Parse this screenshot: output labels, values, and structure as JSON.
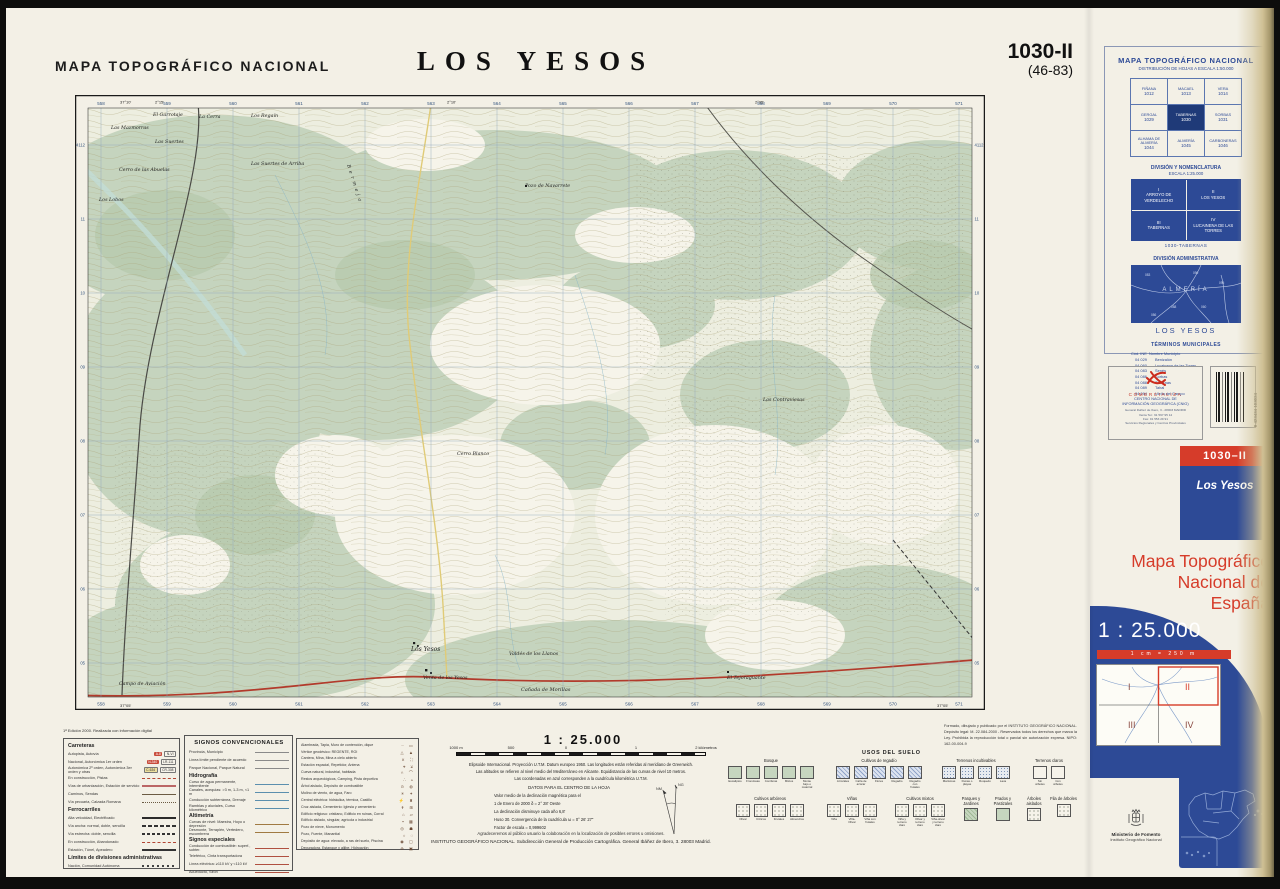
{
  "page": {
    "header_left": "MAPA TOPOGRÁFICO NACIONAL",
    "title": "LOS YESOS",
    "sheet_number": "1030-II",
    "sheet_code": "(46-83)"
  },
  "map": {
    "grid_top": [
      "558",
      "559",
      "560",
      "561",
      "562",
      "563",
      "564",
      "565",
      "566",
      "567",
      "568",
      "569",
      "570",
      "571"
    ],
    "grid_left": [
      "4112",
      "11",
      "10",
      "09",
      "08",
      "07",
      "06",
      "05"
    ],
    "corner_coords": {
      "top_left_lon": "2°15'",
      "top_mid_lon": "2°10'",
      "top_right_lon": "2°05'",
      "left_lat": "37°10'",
      "bottom_lat": "37°05'"
    },
    "places": [
      {
        "name": "El Garrotaje",
        "x": 78,
        "y": 21
      },
      {
        "name": "La Cerra",
        "x": 124,
        "y": 23
      },
      {
        "name": "Los Regaín",
        "x": 176,
        "y": 22
      },
      {
        "name": "Las Mazmorras",
        "x": 36,
        "y": 34
      },
      {
        "name": "Las Suertes",
        "x": 80,
        "y": 48
      },
      {
        "name": "Cerro de las Abuelas",
        "x": 44,
        "y": 76
      },
      {
        "name": "Los Lobos",
        "x": 24,
        "y": 106
      },
      {
        "name": "Las Suertes de Arriba",
        "x": 176,
        "y": 70
      },
      {
        "name": "Pozo de Navarrete",
        "x": 450,
        "y": 92
      },
      {
        "name": "Bermeja",
        "x": 272,
        "y": 70,
        "r": 72,
        "ls": 3
      },
      {
        "name": "Las Contraviesas",
        "x": 688,
        "y": 306
      },
      {
        "name": "Cerro Blanco",
        "x": 382,
        "y": 360
      },
      {
        "name": "Los Yesos",
        "x": 336,
        "y": 556,
        "s": 6
      },
      {
        "name": "Valdés de los Llanos",
        "x": 434,
        "y": 560
      },
      {
        "name": "Venta de los Yesos",
        "x": 348,
        "y": 584
      },
      {
        "name": "Cañada de Morillas",
        "x": 446,
        "y": 596,
        "s": 5
      },
      {
        "name": "El Tejoraguante",
        "x": 652,
        "y": 584
      },
      {
        "name": "Campo de Aviación",
        "x": 44,
        "y": 590
      }
    ]
  },
  "sidebar": {
    "distribution": {
      "title": "MAPA TOPOGRÁFICO NACIONAL",
      "subtitle": "DISTRIBUCIÓN DE HOJAS A ESCALA 1:50.000",
      "cells": [
        {
          "name": "FIÑANA",
          "num": "1012",
          "hl": false
        },
        {
          "name": "MACAEL",
          "num": "1013",
          "hl": false
        },
        {
          "name": "VERA",
          "num": "1014",
          "hl": false
        },
        {
          "name": "GERGAL",
          "num": "1029",
          "hl": false
        },
        {
          "name": "TABERNAS",
          "num": "1030",
          "hl": true
        },
        {
          "name": "SORBAS",
          "num": "1031",
          "hl": false
        },
        {
          "name": "ALHAMA DE ALMERÍA",
          "num": "1044",
          "hl": false
        },
        {
          "name": "ALMERÍA",
          "num": "1045",
          "hl": false
        },
        {
          "name": "CARBONERAS",
          "num": "1046",
          "hl": false
        }
      ]
    },
    "nomenclatura": {
      "title": "DIVISIÓN Y NOMENCLATURA",
      "subtitle": "ESCALA 1:25.000",
      "cells": [
        {
          "roman": "I",
          "name": "ARROYO DE VERDELECHO"
        },
        {
          "roman": "II",
          "name": "LOS YESOS"
        },
        {
          "roman": "III",
          "name": "TABERNAS"
        },
        {
          "roman": "IV",
          "name": "LUCAINENA DE LAS TORRES"
        }
      ],
      "caption": "1030-TABERNAS"
    },
    "admin": {
      "title": "DIVISIÓN ADMINISTRATIVA",
      "region": "ALMERÍA",
      "codes": [
        "083",
        "090",
        "095",
        "088",
        "060",
        "086"
      ],
      "caption": "LOS YESOS"
    },
    "municipios": {
      "title": "TÉRMINOS MUNICIPALES",
      "col1": "Cód. INE",
      "col2": "Nombre Municipio",
      "rows": [
        [
          "04 029",
          "Benizalón"
        ],
        [
          "04 060",
          "Lucainena de las Torres"
        ],
        [
          "04 083",
          "Senés"
        ],
        [
          "04 086",
          "Sorbas"
        ],
        [
          "04 088",
          "Tabernas"
        ],
        [
          "04 089",
          "Tahal"
        ],
        [
          "04 094",
          "Uleila del Campo"
        ]
      ]
    },
    "comercializa": {
      "brand": "COMERCIALIZA",
      "org": [
        "CENTRO NACIONAL DE",
        "INFORMACIÓN GEOGRÁFICA (CNIG)"
      ],
      "address": [
        "General Ibáñez de Ibero, 3 - 28003 MADRID",
        "Venta Tel.: 91 597 95 14",
        "Fax: 91 553 29 91",
        "Servicios Regionales y Centros Provinciales"
      ]
    },
    "barcode_number": "8 423434 103024",
    "sheet_box": {
      "number": "1030–II",
      "name": "Los Yesos"
    },
    "brand_title": [
      "Mapa Topográfico",
      "Nacional de",
      "España"
    ],
    "scale_big": "1 : 25.000",
    "scale_sub": "1 cm = 250 m",
    "quadrants": [
      "I",
      "II",
      "III",
      "IV"
    ],
    "ministry": {
      "line1": "Ministerio de Fomento",
      "line2": "Instituto Geográfico Nacional"
    }
  },
  "legend": {
    "edition_note": "1ª Edición 2000. Realizada con información digital",
    "carreteras": {
      "title": "Carreteras",
      "items": [
        {
          "label": "Autopista, Autovía",
          "badges": [
            {
              "t": "A-8",
              "style": "red"
            },
            {
              "t": "N-VI",
              "style": "outline"
            }
          ]
        },
        {
          "label": "Nacional, Autonómica 1er orden",
          "badges": [
            {
              "t": "N-340",
              "style": "red"
            },
            {
              "t": "LR-111",
              "style": "outline"
            }
          ]
        },
        {
          "label": "Autonómica 2º orden, Autonómica 3er orden y otras",
          "badges": [
            {
              "t": "C-634",
              "style": "yellow"
            },
            {
              "t": "CR-308",
              "style": "outline"
            }
          ]
        },
        {
          "label": "En construcción, Pistas",
          "sw": "constr"
        },
        {
          "label": "Vías de urbanización, Estación de servicio",
          "sw": "serv"
        },
        {
          "label": "Caminos, Sendas",
          "sw": "camino"
        },
        {
          "label": "Vía pecuaria, Calzada Romana",
          "sw": "pecuaria"
        }
      ]
    },
    "ferrocarriles": {
      "title": "Ferrocarriles",
      "items": [
        {
          "label": "Alta velocidad, Electrificado",
          "sw": "hs"
        },
        {
          "label": "Vía ancha: normal, doble, sencilla",
          "sw": "rail2"
        },
        {
          "label": "Vía estrecha: doble, sencilla",
          "sw": "rail1"
        },
        {
          "label": "En construcción, Abandonado",
          "sw": "constr"
        },
        {
          "label": "Estación, Túnel, Apeadero",
          "sw": "station"
        }
      ]
    },
    "limites": {
      "title": "Límites de divisiones administrativas",
      "items": [
        {
          "label": "Nación, Comunidad Autónoma",
          "sw": "limdots"
        }
      ]
    },
    "signos": {
      "title": "SIGNOS CONVENCIONALES",
      "groups": [
        {
          "header": "",
          "color": "#8a8a8a",
          "items": [
            "Provincia, Municipio",
            "Línea límite pendiente de acuerdo",
            "Parque Nacional, Parque Natural"
          ]
        },
        {
          "header": "Hidrografía",
          "color": "#5b8fae",
          "items": [
            "Curso de agua permanente, intermitente",
            "Canales, acequias: >3 m, 1-3 m, <1 m",
            "Conducción subterránea, Drenaje",
            "Ramblas y aluviales, Curso kilométrico"
          ]
        },
        {
          "header": "Altimetría",
          "color": "#a07a42",
          "items": [
            "Curvas de nivel: Maestra, Hoyo o depresión",
            "Desmonte, Terraplén, Vertedero, escombrera"
          ]
        },
        {
          "header": "Signos especiales",
          "color": "#b05040",
          "items": [
            "Conducción de combustible: superf., subter.",
            "Teleférico, Cinta transportadora",
            "Línea eléctrica: ≥110 kV y <110 kV",
            "Acueducto, Sifón"
          ]
        }
      ]
    },
    "simbolos": [
      {
        "label": "Alambrada, Tapia, Muro de contención, dique",
        "gl": "┄ ▭"
      },
      {
        "label": "Vértice geodésico: REGENTE, ROI",
        "gl": "△ ▲"
      },
      {
        "label": "Cantera, Mina, Mina a cielo abierto",
        "gl": "⨯ ⛶"
      },
      {
        "label": "Estación espacial, Repetidor, Antena",
        "gl": "⌖ ⊻"
      },
      {
        "label": "Cueva natural, industrial, habitada",
        "gl": "∩ ⌒"
      },
      {
        "label": "Restos arqueológicos, Camping, Pista deportiva",
        "gl": "∴ ▵"
      },
      {
        "label": "Árbol aislado, Depósito de combustible",
        "gl": "⊙ ◍"
      },
      {
        "label": "Molino de viento, de agua, Faro",
        "gl": "✳ ✦"
      },
      {
        "label": "Central eléctrica: hidráulica, térmica, Castillo",
        "gl": "⚡ ♜"
      },
      {
        "label": "Cruz aislada, Cementerio: Iglesia y cementerio",
        "gl": "✝ ⊞"
      },
      {
        "label": "Edificio religioso: cristiano, Edificio en ruinas, Corral",
        "gl": "⌂ ▱"
      },
      {
        "label": "Edificio aislado, singular, agrícola o industrial",
        "gl": "▪ ▦"
      },
      {
        "label": "Pozo de nieve, Monumento",
        "gl": "◎ ☗"
      },
      {
        "label": "Pozo, Fuente, Manantial",
        "gl": "○ ◌"
      },
      {
        "label": "Depósito de agua: elevado, a ras del suelo, Piscina",
        "gl": "◉ ▢"
      },
      {
        "label": "Depuradora, Estanque y aljibe, Hidroavión",
        "gl": "⊕ ▣"
      }
    ],
    "scale_title": "1 : 25.000",
    "scale_bar_labels": [
      "1000 m",
      "500",
      "0",
      "1",
      "2 kilómetros"
    ],
    "geodesy": [
      "Elipsoide Internacional. Proyección U.T.M. Datum europeo 1950. Las longitudes están referidas al meridiano de Greenwich.",
      "Las altitudes se refieren al nivel medio del Mediterráneo en Alicante. Equidistancia de las curvas de nivel 10 metros.",
      "Las coordenadas en azul corresponden a la cuadrícula kilométrica U.T.M."
    ],
    "datos": {
      "title": "DATOS PARA EL CENTRO DE LA HOJA",
      "lines": [
        "Valor medio de la declinación magnética para el",
        "1 de Enero de 2000    δ = 2° 28' Oeste",
        "La declinación disminuye cada año 6,8'",
        "Huso 30. Convergencia de la cuadrícula  ω = 0° 26' 27\"",
        "Factor de escala  =  0,999602"
      ],
      "diagram_labels": [
        "NG",
        "NM"
      ]
    },
    "formado": [
      "Formado, dibujado y publicado por el INSTITUTO GEOGRÁFICO NACIONAL.",
      "Depósito legal: M. 22.084-2000 - Reservados todos los derechos que marca",
      "la Ley. Prohibida la reproducción total o parcial sin autorización expresa.",
      "NIPO: 162-00-004-9"
    ],
    "usos": {
      "title": "USOS DEL SUELO",
      "groups": [
        {
          "name": "Bosque",
          "type": "green",
          "items": [
            "Eucaliptos",
            "Frondosas",
            "Coníferas",
            "Mixtos",
            "Monte bajo o matorral"
          ]
        },
        {
          "name": "Cultivos de regadío",
          "type": "bluehatch",
          "items": [
            "Arrozales",
            "Caña de azúcar",
            "Flores",
            "Regadío",
            "Regadío con frutales"
          ]
        },
        {
          "name": "Terrenos incultivables",
          "type": "misc",
          "items": [
            "Marismas",
            "Dunas o playas",
            "Roquedo",
            "Lava"
          ]
        },
        {
          "name": "Terrenos claros",
          "type": "plain",
          "items": [
            "Sin árboles",
            "Con árboles"
          ]
        },
        {
          "name": "Cultivos arbóreos",
          "type": "dots",
          "items": [
            "Olivar",
            "Cítricos",
            "Frutales",
            "Almendros"
          ]
        },
        {
          "name": "Viñas",
          "type": "dots",
          "items": [
            "Viña",
            "Viña-Olivar",
            "Viña con frutales"
          ]
        },
        {
          "name": "Cultivos mixtos",
          "type": "dots",
          "items": [
            "Viña y terreno claro",
            "Olivar y terreno claro",
            "Viña-olivar y terreno claro"
          ]
        },
        {
          "name": "Parques y Jardines",
          "type": "greenhatch",
          "items": [
            ""
          ]
        },
        {
          "name": "Prados y Pastizales",
          "type": "green",
          "items": [
            ""
          ]
        },
        {
          "name": "Árboles aislados",
          "type": "dots",
          "items": [
            ""
          ]
        },
        {
          "name": "Fila de árboles",
          "type": "dots",
          "items": [
            ""
          ]
        }
      ]
    },
    "footer": [
      "Agradeceremos al público usuario la colaboración en la localización de posibles errores u omisiones.",
      "INSTITUTO GEOGRÁFICO NACIONAL. Subdirección General de Producción Cartográfica. General Ibáñez de Ibero, 3. 28003 Madrid."
    ]
  },
  "colors": {
    "panel_blue": "#2d4a96",
    "highlight_blue": "#1f3a78",
    "accent_red": "#d63c2a",
    "map_green": "#c5d4be",
    "road_red": "#b23a2b"
  }
}
